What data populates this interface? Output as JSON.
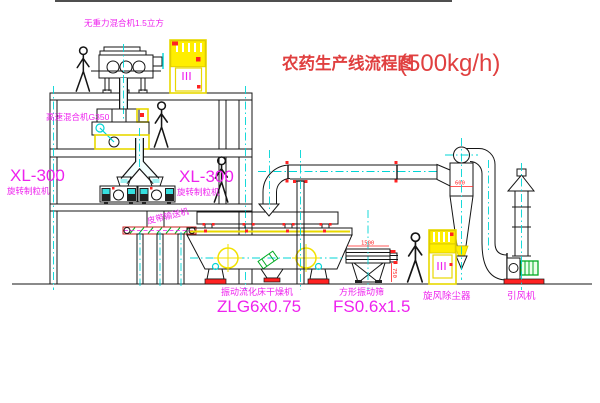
{
  "title": {
    "cn": "农药生产线流程图",
    "capacity": "(500kg/h)"
  },
  "labels": {
    "top_mixer": "无重力混合机1.5立方",
    "high_speed_mixer": "高速混合机G350",
    "granulator_left_model": "XL-300",
    "granulator_left_name": "旋转制粒机",
    "granulator_right_model": "XL-300",
    "granulator_right_name": "旋转制粒机",
    "belt_conveyor": "皮带输送机",
    "dryer_name": "振动流化床干燥机",
    "dryer_model": "ZLG6x0.75",
    "sieve_name": "方形振动筛",
    "sieve_model": "FS0.6x1.5",
    "cyclone": "旋风除尘器",
    "fan": "引风机"
  },
  "dimensions": {
    "cyclone_dia": "600",
    "sieve_width": "1500",
    "sieve_side": "750"
  },
  "colors": {
    "label_magenta": "#EE22EE",
    "title_red": "#E04040",
    "dimension_red": "#FF2222",
    "machine_yellow": "#FFEE00",
    "centerline_cyan": "#00D5D5",
    "motor_green": "#00AA22",
    "line_black": "#151515"
  }
}
